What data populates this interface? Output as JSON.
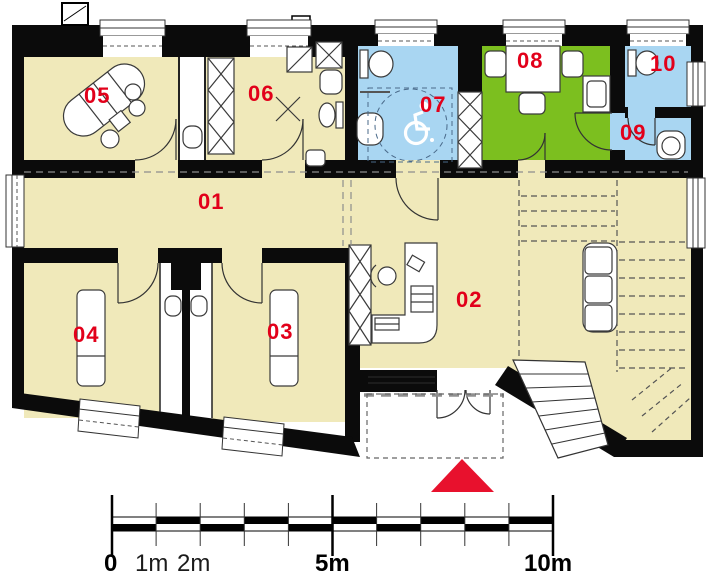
{
  "rooms": [
    {
      "number": "01",
      "fill": "#f0e9ba"
    },
    {
      "number": "02",
      "fill": "#f0e9ba"
    },
    {
      "number": "03",
      "fill": "#f0e9ba"
    },
    {
      "number": "04",
      "fill": "#f0e9ba"
    },
    {
      "number": "05",
      "fill": "#f0e9ba"
    },
    {
      "number": "06",
      "fill": "#f0e9ba"
    },
    {
      "number": "07",
      "fill": "#a9d6f2"
    },
    {
      "number": "08",
      "fill": "#7cbf1f"
    },
    {
      "number": "09",
      "fill": "#a9d6f2"
    },
    {
      "number": "10",
      "fill": "#a9d6f2"
    }
  ],
  "scale_bar": {
    "labels": [
      "0",
      "1m",
      "2m",
      "5m",
      "10m"
    ],
    "total_meters": 10,
    "tick_interval_meters": 1
  },
  "markers": {
    "entrance_triangle_color": "#e8112d",
    "accessibility_icon": "wheelchair-icon"
  },
  "colors": {
    "wall": "#0b0b0b",
    "cream": "#f0e9ba",
    "blue": "#a9d6f2",
    "green": "#7cbf1f",
    "room_number_red": "#e2001a"
  }
}
